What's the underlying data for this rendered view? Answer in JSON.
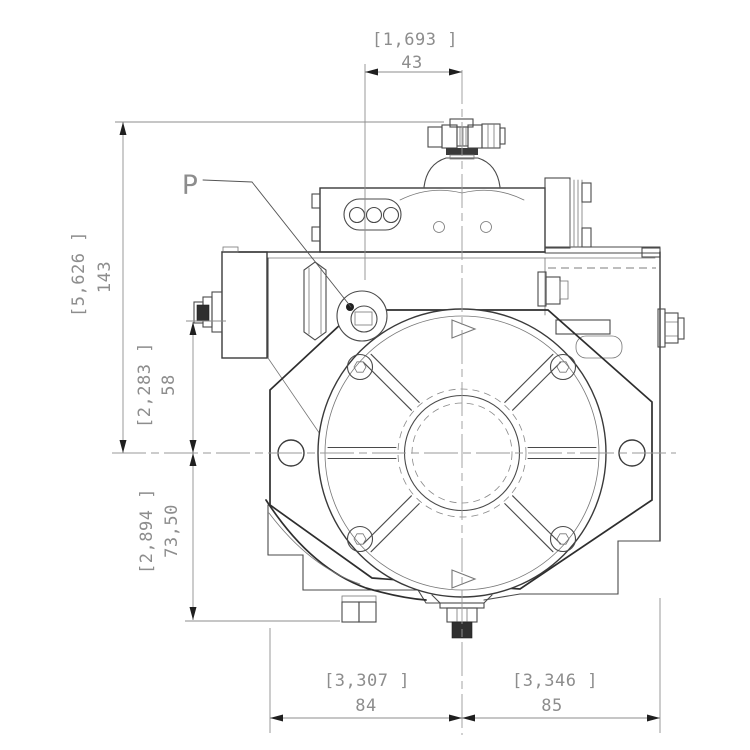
{
  "port": {
    "label": "P"
  },
  "dimensions": {
    "top_width": {
      "inch": "[1,693 ]",
      "mm": "43"
    },
    "total_height": {
      "inch": "[5,626 ]",
      "mm": "143"
    },
    "port_height": {
      "inch": "[2,283 ]",
      "mm": "58"
    },
    "lower_height": {
      "inch": "[2,894 ]",
      "mm": "73,50"
    },
    "bottom_left_width": {
      "inch": "[3,307 ]",
      "mm": "84"
    },
    "bottom_right_width": {
      "inch": "[3,346 ]",
      "mm": "85"
    }
  },
  "colors": {
    "background": "#ffffff",
    "outline": "#3a3a3a",
    "outline_light": "#777777",
    "dimension_line": "#8d8d8d",
    "dimension_text": "#8d8d8d",
    "arrowhead": "#1f1f1f",
    "centerline": "#9a9a9a"
  }
}
